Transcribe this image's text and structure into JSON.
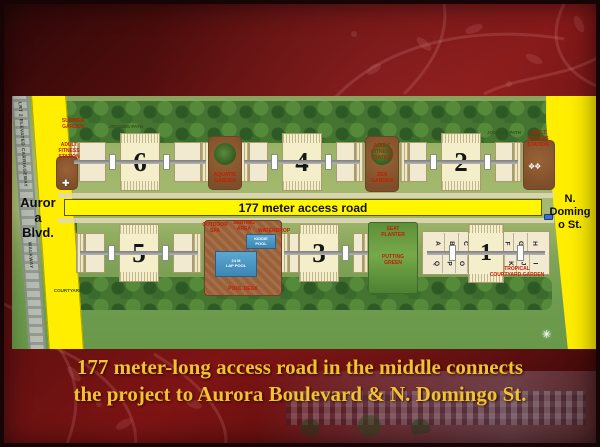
{
  "slide": {
    "caption": {
      "line1": "177 meter-long access road in the middle connects",
      "line2": "the project to Aurora Boulevard & N. Domingo St."
    }
  },
  "siteplan": {
    "access_road_label": "177 meter access road",
    "aurora_blvd_label": "Auror\na\nBlvd.",
    "n_domingo_label": "N.\nDoming\no St.",
    "lrt_label": "LRT 2 ELEVATED CARRIAGEWAY",
    "walkway_label": "WALKWAY",
    "buildings_top": [
      {
        "number": "6"
      },
      {
        "number": "4"
      },
      {
        "number": "2"
      }
    ],
    "buildings_bottom": [
      {
        "number": "5"
      },
      {
        "number": "3"
      },
      {
        "number": "1"
      }
    ],
    "building1_letters_top": [
      "A",
      "B",
      "C",
      "D",
      "E",
      "F",
      "G",
      "H"
    ],
    "building1_letters_bottom": [
      "Q",
      "P",
      "O",
      "N",
      "M",
      "L",
      "K",
      "J",
      "I"
    ],
    "amenities": {
      "summer_garden": "SUMMER\nGARDEN",
      "jogging_path_left": "JOGGING PATH",
      "adult_fitness_left": "ADULT\nFITNESS\nSTATION",
      "aquatic_garden": "AQUATIC\nGARDEN",
      "adult_fitness_mid": "ADULT\nFITNESS\nSTATION",
      "zen_garden": "ZEN\nGARDEN",
      "jogging_path_right": "JOGGING PATH",
      "adult_fitness_right": "ADULT\nFITNESS\nSTATION",
      "courtyard": "COURTYARD",
      "outdoor_spa": "OUTDOOR\nSPA",
      "seating_area": "SEATING\nAREA",
      "waterdrop": "WATERDROP",
      "kiddie_pool": "KIDDIE\nPOOL",
      "lap_pool": "24 M\nLAP POOL",
      "pool_deck": "POOL  DECK",
      "seat_planter": "SEAT\nPLANTER",
      "putting_green": "PUTTING\nGREEN",
      "tropical_garden": "TROPICAL\nCOURTYARD GARDEN"
    },
    "colors": {
      "road_yellow": "#ffee00",
      "slide_red": "#7e1414",
      "caption_gold": "#f2c12d",
      "grass_green": "#9db468",
      "tree_green": "#44742f",
      "building_cream": "#f1ead0",
      "pool_blue": "#4a9dc8",
      "deck_brown": "#9a6038"
    }
  }
}
